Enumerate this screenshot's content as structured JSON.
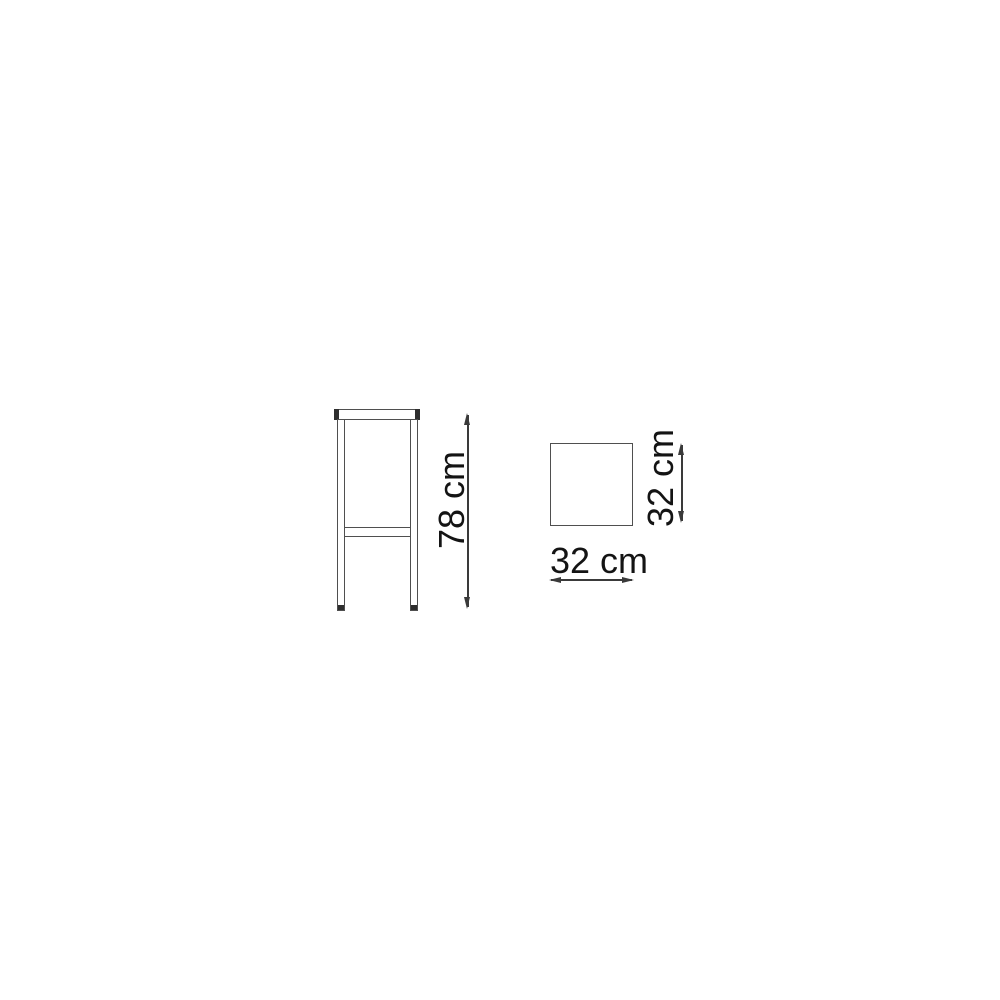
{
  "drawing": {
    "subject": "bar stool dimension diagram",
    "dimensions": {
      "height": "78 cm",
      "seat_depth": "32 cm",
      "seat_width": "32 cm"
    },
    "colors": {
      "background": "#ffffff",
      "outline": "#4f4f4f",
      "dimension": "#3a3a3a",
      "accent_dark": "#2e2e2e",
      "text": "#141414"
    }
  }
}
